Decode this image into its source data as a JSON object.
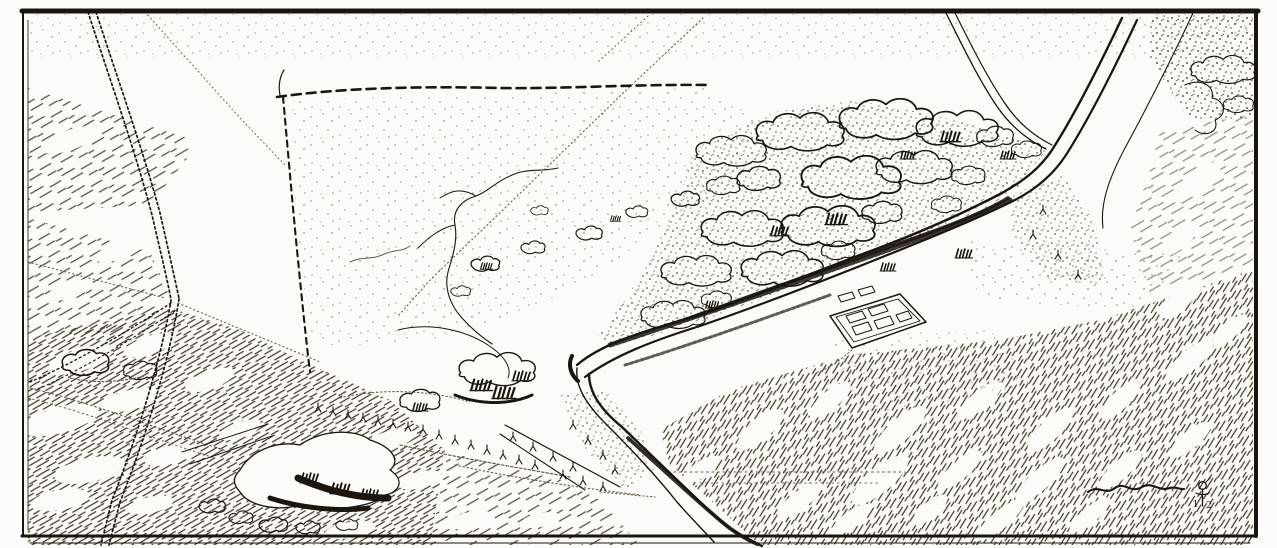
{
  "artwork": {
    "medium": "pen-and-ink aerial perspective landscape drawing",
    "style": "engraved line illustration, black ink on white paper, heavy rectangular border",
    "colors": {
      "paper": "#fcfbf7",
      "ink": "#1b150e",
      "hatch": "#46392b",
      "faint": "#6a5c4a"
    },
    "monogram": {
      "label": "artist monogram",
      "digit_left": "1",
      "digit_right": "2"
    },
    "features": [
      {
        "name": "border-frame",
        "description": "heavy rectangular ink border around the drawing"
      },
      {
        "name": "country-lane",
        "description": "hedged lane running from the top edge to the bottom left, with a junction midway"
      },
      {
        "name": "field-paths",
        "description": "faint dotted footpaths crossing the fields diagonally"
      },
      {
        "name": "large-field",
        "description": "big open stippled field bounded by dashed hedgerows, upper left of centre"
      },
      {
        "name": "winding-stream",
        "description": "small meandering stream inside the large field"
      },
      {
        "name": "river",
        "description": "river entering at top right, bending sharply at centre and leaving at bottom centre"
      },
      {
        "name": "riverside-woodland",
        "description": "dense cloud-like tree canopies along the north bank of the river"
      },
      {
        "name": "villa-enclosure",
        "description": "small rectangular walled farmstead with courtyard buildings, centre right"
      },
      {
        "name": "scrub-mound",
        "description": "low mound covered in dark scrub, bottom left"
      },
      {
        "name": "hatched-meadows",
        "description": "diagonal hatching over the surrounding meadows and corners"
      },
      {
        "name": "tree-rows",
        "description": "rows of small trees along banks, hedges and a causeway"
      },
      {
        "name": "illegible-scribble",
        "description": "illegible pen scrawl near the lower right"
      },
      {
        "name": "artist-monogram",
        "description": "small monogram device with the digits 1 and 2, lower right"
      }
    ]
  }
}
